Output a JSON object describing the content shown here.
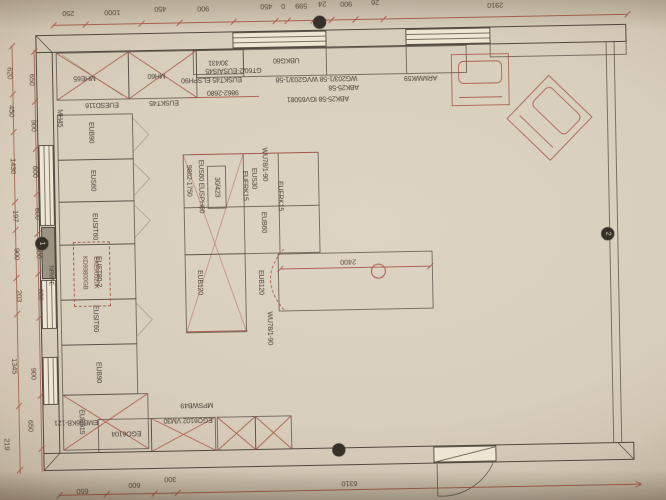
{
  "document": {
    "kind": "kitchen floor plan photograph, drawing rotated 180 degrees"
  },
  "colors": {
    "paper": "#d8cebc",
    "line": "#4f483e",
    "red": "#a84e42",
    "wall_fill": "#b6ad9e"
  },
  "top_dims": [
    "250",
    "1000",
    "450",
    "900",
    "450",
    "0",
    "599",
    "24",
    "900",
    "26",
    "2910"
  ],
  "left_outer_dims": [
    "620",
    "450",
    "1430",
    "197",
    "900",
    "203",
    "1345",
    "219"
  ],
  "left_inner_dims": [
    "650",
    "900",
    "600",
    "600",
    "800",
    "600",
    "900",
    "650"
  ],
  "bottom_dims": [
    "650",
    "600",
    "300",
    "6310"
  ],
  "top_labels": [
    "MHE65",
    "MH60",
    "EUESD116",
    "EUSKT45",
    "30/431",
    "UBKG60",
    "GT60/2-EUSAIS45",
    "EUSKT45 ELSPH90",
    "9862-2680",
    "WG203/1-58 WVG203/1-58",
    "ABK25-58",
    "ABK25-58 IGV65081",
    "ARMWK59"
  ],
  "left_labels": [
    "MH45",
    "EUB90",
    "EUS60",
    "EUSIT60",
    "EUST80-2",
    "EUSIT60",
    "EUB90",
    "EUB915",
    "EMB96KB-121",
    "NRW-E"
  ],
  "appliance_labels": [
    "KD93800GB",
    "EKE96520K"
  ],
  "center_labels": [
    "9862-1750",
    "EUS60 EUSPH60",
    "30/423",
    "EUFRK15",
    "EUS30",
    "WU78/1-90",
    "EUFRK15",
    "EUB60",
    "EUB120",
    "EUB120",
    "WU78/1-90"
  ],
  "island_dim": "2400",
  "bottom_labels": [
    "MPSWB49",
    "EGO6102 VM30",
    "EGO6104"
  ],
  "badges": [
    "1",
    "",
    "",
    "2"
  ]
}
